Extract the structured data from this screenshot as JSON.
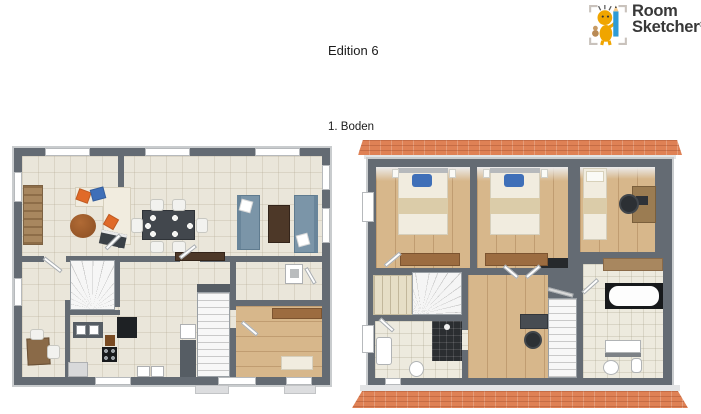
{
  "header": {
    "logo": {
      "line1": "Room",
      "line2": "Sketcher",
      "registered": "®"
    }
  },
  "title": "Edition 6",
  "right_plan_label": "1. Boden",
  "colors": {
    "text": "#1b1b1b",
    "wall": "#646b73",
    "wall_edge": "#c9ccce",
    "tile_floor": "#eae6da",
    "bath_tile": "#edeade",
    "wood_floor": "#d7b78b",
    "roof": "#df8155",
    "cream": "#f1ecdf",
    "sofa_blue": "#7b95a8",
    "dark_brown": "#4d3828",
    "wood_brown": "#a8875f",
    "ottoman_brown": "#a95f2f",
    "accent_orange": "#e06a28",
    "accent_blue": "#3f6fb8",
    "counter_dark": "#565d64",
    "appliance_black": "#1e2124",
    "shower_dark": "#2b2e31",
    "rug_brown": "#9c6c40",
    "chair_dark": "#2c3034",
    "logo_yellow": "#f0a500",
    "logo_pencil": "#2e9bd6"
  },
  "plans": {
    "left": {
      "furniture": [
        "sectional-sofa",
        "orange-pillows",
        "blue-pillow",
        "round-ottoman",
        "wooden-sideboard",
        "dining-table-with-six-chairs",
        "blue-sofa-pair",
        "coffee-table",
        "tv-sideboard",
        "winder-staircase",
        "second-staircase",
        "kitchen-sink-counter",
        "fridge",
        "stove",
        "dishwasher",
        "washer-dryer",
        "office-desk-with-chairs",
        "utility-appliance",
        "entry-rug",
        "entry-bench"
      ]
    },
    "right": {
      "furniture": [
        "double-bed-1",
        "double-bed-2",
        "single-bed",
        "bedroom-desk-with-office-chair",
        "wardrobe-closet",
        "winder-staircase",
        "straight-staircase",
        "bathtub",
        "shower",
        "toilet-1",
        "toilet-2",
        "vanity-1",
        "vanity-2",
        "hall-desk-with-office-chair",
        "chimney-block",
        "brown-counter",
        "bedroom-rugs"
      ]
    }
  }
}
